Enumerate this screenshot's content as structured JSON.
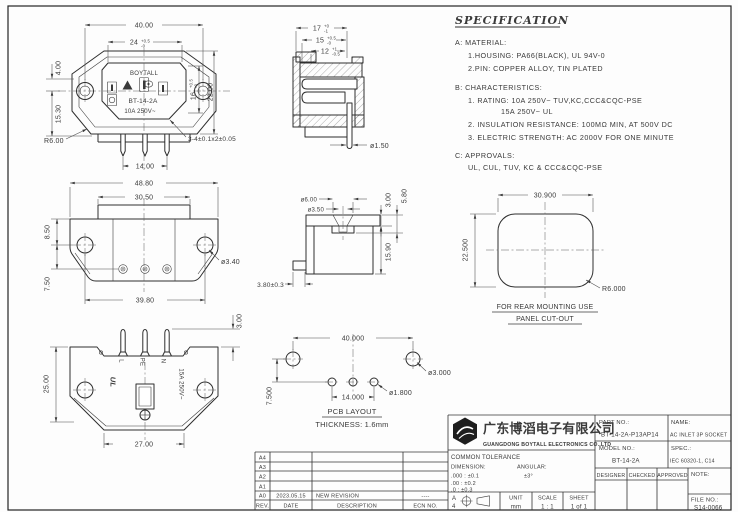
{
  "spec": {
    "title": "SPECIFICATION",
    "a": "A: MATERIAL:",
    "a1": "1.HOUSING: PA66(BLACK), UL 94V-0",
    "a2": "2.PIN: COPPER ALLOY, TIN PLATED",
    "b": "B: CHARACTERISTICS:",
    "b1": "1. RATING: 10A 250V~ TUV,KC,CCC&CQC-PSE",
    "b1b": "15A 250V~ UL",
    "b2": "2. INSULATION RESISTANCE: 100MΩ MIN, AT 500V DC",
    "b3": "3. ELECTRIC STRENGTH: AC 2000V FOR ONE MINUTE",
    "c": "C: APPROVALS:",
    "c1": "UL, CUL, TUV, KC & CCC&CQC-PSE"
  },
  "front": {
    "dim_40": "40.00",
    "dim_24": "24",
    "dim_24_up": "+0.5",
    "dim_24_dn": "-0",
    "dim_4": "4.00",
    "dim_15_30": "15.30",
    "dim_16": "16",
    "dim_16_up": "+0.5",
    "dim_16_dn": "-0",
    "dim_22": "22.00",
    "r6": "R6.00",
    "dim_14": "14.00",
    "pin_note": "3-4±0.1x2±0.05",
    "brand": "BOYTALL",
    "model": "BT-14-2A",
    "rating": "10A 250V~"
  },
  "side": {
    "dim_17": "17",
    "dim_17_up": "+0",
    "dim_17_dn": "-1",
    "dim_15": "15",
    "dim_15_up": "+0.5",
    "dim_15_dn": "-0",
    "dim_12": "12",
    "dim_12_up": "+1",
    "dim_12_dn": "-0.5",
    "pin_dia": "ø1.50"
  },
  "rear": {
    "dim_48_80": "48.80",
    "dim_30_50": "30.50",
    "dim_8_50": "8.50",
    "dim_7_50": "7.50",
    "hole_dia": "ø3.40",
    "dim_39_80": "39.80"
  },
  "sideb": {
    "dia_6": "ø6.00",
    "dia_3_5": "ø3.50",
    "dim_3": "3.00",
    "dim_5_8": "5.80",
    "dim_15_9": "15.90",
    "dim_3_8": "3.80±0.3"
  },
  "cutout": {
    "dim_w": "30.900",
    "dim_h": "22.500",
    "r": "R6.000",
    "cap1": "FOR REAR MOUNTING USE",
    "cap2": "PANEL CUT-OUT"
  },
  "bottom": {
    "dim_h": "25.00",
    "dim_w": "27.00",
    "dim_pin": "3.00",
    "pin_l": "L",
    "pin_pe": "PE",
    "pin_n": "N",
    "rating": "15A 250V~",
    "ul": "UL"
  },
  "pcb": {
    "dim_40": "40.000",
    "dim_14": "14.000",
    "dim_7_5": "7.500",
    "dia_3": "ø3.000",
    "dia_1_8": "ø1.800",
    "cap1": "PCB LAYOUT",
    "cap2": "THICKNESS: 1.6mm"
  },
  "tb": {
    "company_cn": "广东博滔电子有限公司",
    "company_en": "GUANGDONG BOYTALL ELECTRONICS CO.,LTD",
    "part_label": "PART NO.:",
    "part_no": "BT-14-2A-P13AP14",
    "name_label": "NAME:",
    "name": "AC INLET 3P SOCKET",
    "model_label": "MODEL NO.:",
    "model": "BT-14-2A",
    "spec_label": "SPEC.:",
    "spec": "IEC 60320-1, C14",
    "designer": "DESIGNER",
    "checked": "CHECKED",
    "approved": "APPROVED",
    "note_label": "NOTE:",
    "file_label": "FILE NO.:",
    "file_no": "S14-0066",
    "tol_title": "COMMON TOLERANCE",
    "dim_label": "DIMENSION:",
    "ang_label": "ANGULAR:",
    "tol_1": ".000 : ±0.1",
    "tol_ang": "±3°",
    "tol_2": ".00 : ±0.2",
    "tol_3": ".0 : ±0.3",
    "size_a": "A",
    "size_4": "4",
    "unit_label": "UNIT",
    "unit": "mm",
    "scale_label": "SCALE",
    "scale": "1 : 1",
    "sheet_label": "SHEET",
    "sheet": "1 of 1"
  },
  "rev": {
    "rows": [
      [
        "A4",
        "",
        "",
        ""
      ],
      [
        "A3",
        "",
        "",
        ""
      ],
      [
        "A2",
        "",
        "",
        ""
      ],
      [
        "A1",
        "",
        "",
        ""
      ],
      [
        "A0",
        "2023.05.15",
        "NEW REVISION",
        "----"
      ]
    ],
    "headers": [
      "REV.",
      "DATE",
      "DESCRIPTION",
      "ECN NO."
    ]
  }
}
